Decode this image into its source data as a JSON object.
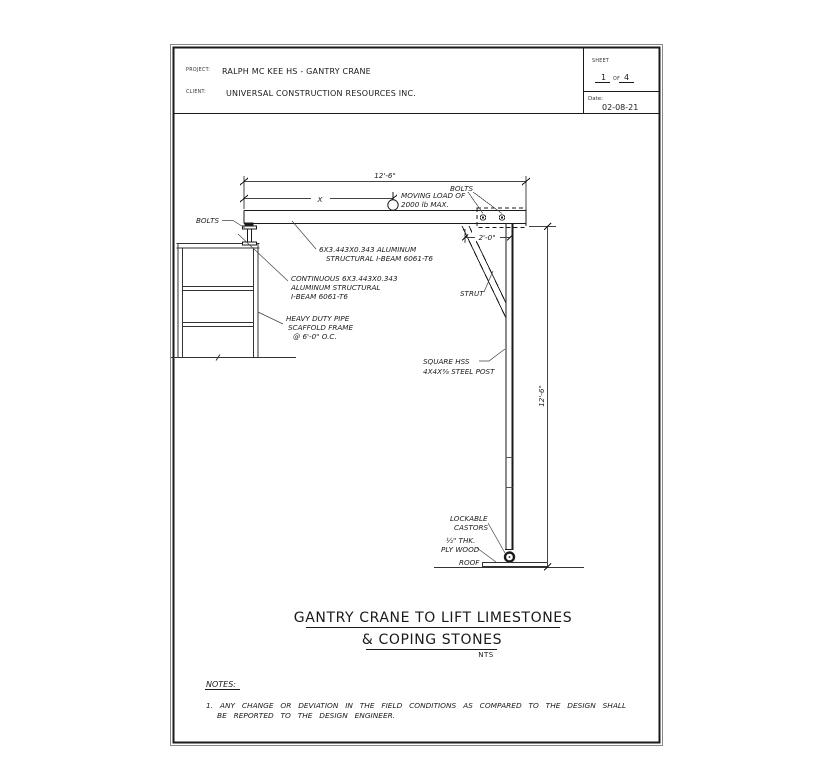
{
  "header": {
    "project_label": "PROJECT:",
    "project_value": "RALPH MC KEE HS - GANTRY CRANE",
    "client_label": "CLIENT:",
    "client_value": "UNIVERSAL CONSTRUCTION RESOURCES INC.",
    "sheet_label": "SHEET",
    "sheet_number": "1",
    "sheet_of_label": "OF",
    "sheet_total": "4",
    "date_label": "Date:",
    "date_value": "02-08-21"
  },
  "dimensions": {
    "beam_length": "12'-6\"",
    "trolley_position": "X",
    "strut_offset": "2'-0\"",
    "post_height": "12'-6\""
  },
  "annotations": {
    "bolts_left": "BOLTS",
    "bolts_right": "BOLTS",
    "moving_load_line1": "MOVING LOAD OF",
    "moving_load_line2": "2000 lb MAX.",
    "beam_spec_line1": "6X3.443X0.343 ALUMINUM",
    "beam_spec_line2": "STRUCTURAL I-BEAM 6061-T6",
    "cont_beam_line1": "CONTINUOUS 6X3.443X0.343",
    "cont_beam_line2": "ALUMINUM STRUCTURAL",
    "cont_beam_line3": "I-BEAM 6061-T6",
    "scaffold_line1": "HEAVY DUTY PIPE",
    "scaffold_line2": "SCAFFOLD FRAME",
    "scaffold_line3": "@ 6'-0\" O.C.",
    "strut": "STRUT",
    "post_line1": "SQUARE HSS",
    "post_line2": "4X4X⅜ STEEL POST",
    "castors_line1": "LOCKABLE",
    "castors_line2": "CASTORS",
    "plywood_line1": "½\" THK.",
    "plywood_line2": "PLY WOOD",
    "roof": "ROOF"
  },
  "title": {
    "line1": "GANTRY CRANE TO LIFT LIMESTONES",
    "line2": "& COPING STONES",
    "scale": "NTS"
  },
  "notes": {
    "heading": "NOTES:",
    "item1_line1": "1. ANY CHANGE OR DEVIATION IN THE FIELD CONDITIONS AS COMPARED TO THE DESIGN SHALL",
    "item1_line2": "BE REPORTED TO THE DESIGN ENGINEER."
  },
  "colors": {
    "ink": "#1a1a1a",
    "thin_line": "#444444",
    "background": "#ffffff"
  }
}
